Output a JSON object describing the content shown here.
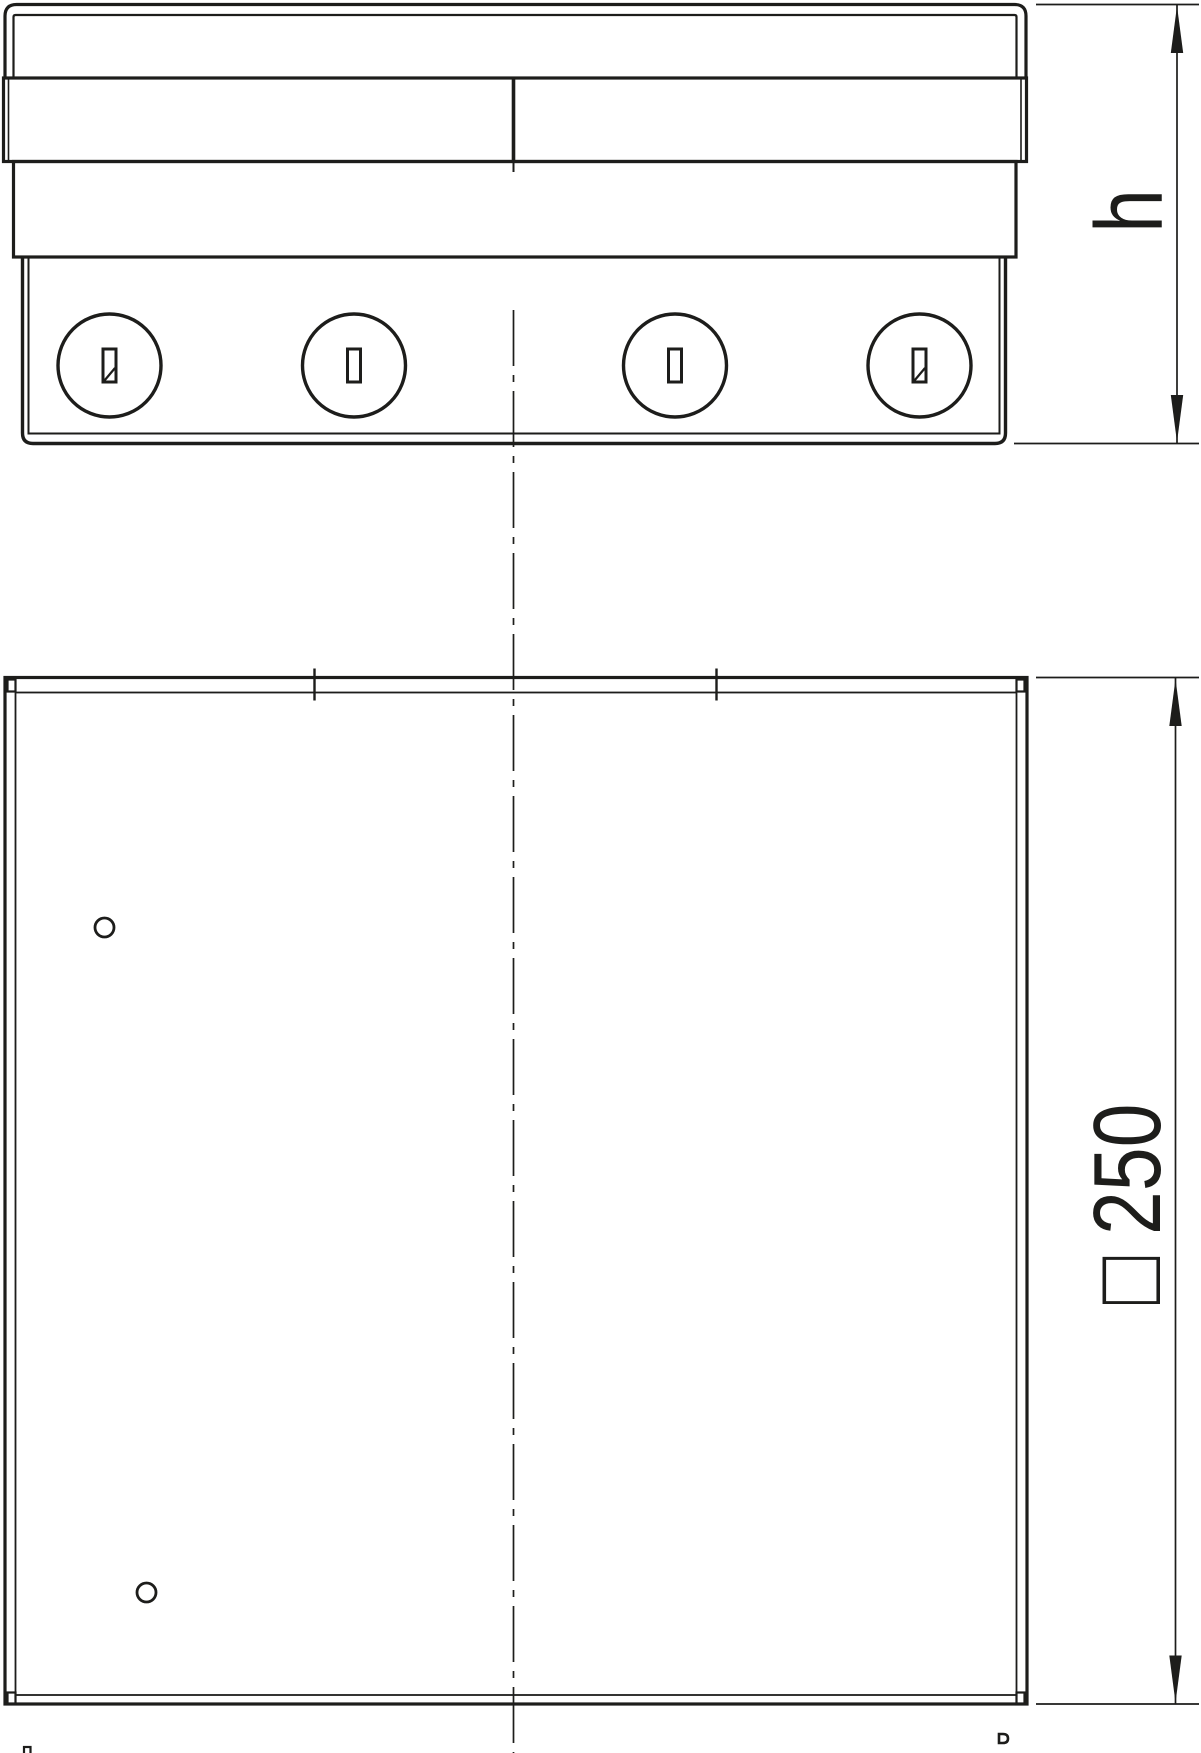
{
  "page": {
    "kind": "technical drawing with two orthographic views of a square cassette with four quarter-turn screws",
    "background_color": "#ffffff",
    "line_color": "#1d1d1b"
  },
  "side_view": {
    "name": "front elevation",
    "screw_count": 4,
    "screw_slot": "vertical-slot",
    "cover_seam": "center split"
  },
  "plan_view": {
    "name": "top view",
    "pilot_hole_count": 2,
    "seam_tick_count": 2
  },
  "dimensions": {
    "height": {
      "label": "h"
    },
    "width": {
      "label": "□ 250",
      "symbol": "□",
      "value": "250"
    }
  }
}
